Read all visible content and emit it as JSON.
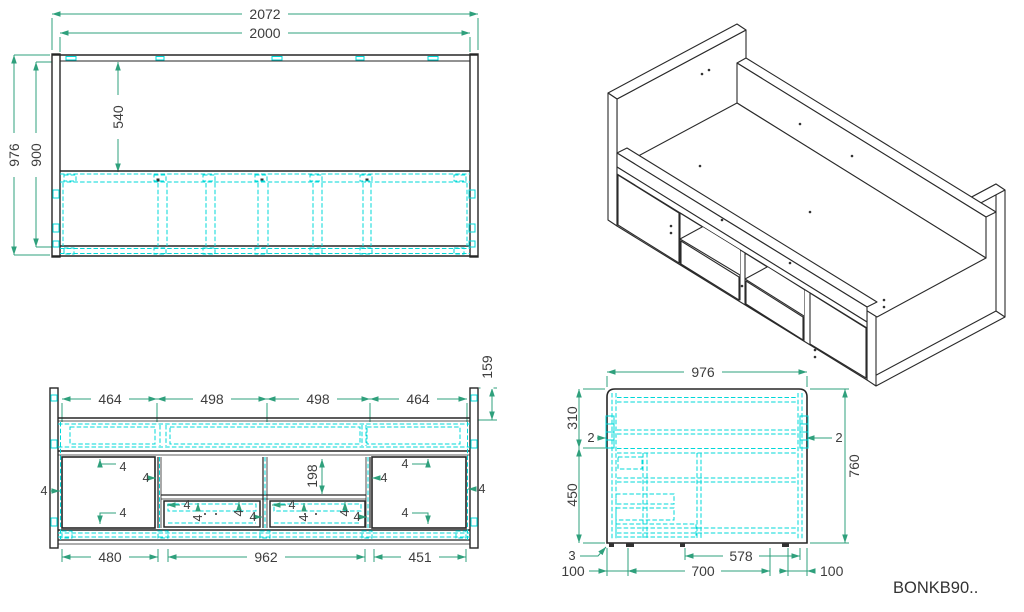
{
  "drawing": {
    "product_code": "BONKB90..",
    "colors": {
      "outline": "#262626",
      "hidden_line": "#00d8d8",
      "dimension_line": "#2fa07c",
      "dim_text": "#3d3d3d"
    },
    "views": {
      "rear_elevation": {
        "dims": {
          "overall_width": "2072",
          "inner_width": "2000",
          "overall_height": "976",
          "inner_height": "900",
          "upper_panel_height": "540"
        }
      },
      "front_detail": {
        "dims": {
          "bay_outer_left": "464",
          "bay_inner_left": "498",
          "bay_inner_right": "498",
          "bay_outer_right": "464",
          "top_offset": "159",
          "niche_opening_height": "198",
          "gap": "4",
          "left_door_width": "480",
          "niche_width": "962",
          "right_door_width": "451"
        }
      },
      "side_section": {
        "dims": {
          "depth": "976",
          "upper_section": "310",
          "lower_section": "450",
          "panel_gap": "2",
          "interior_height": "760",
          "foot_height": "3",
          "foot_inset_front": "100",
          "foot_spacing": "700",
          "rear_span": "578",
          "foot_inset_rear": "100"
        }
      }
    }
  }
}
